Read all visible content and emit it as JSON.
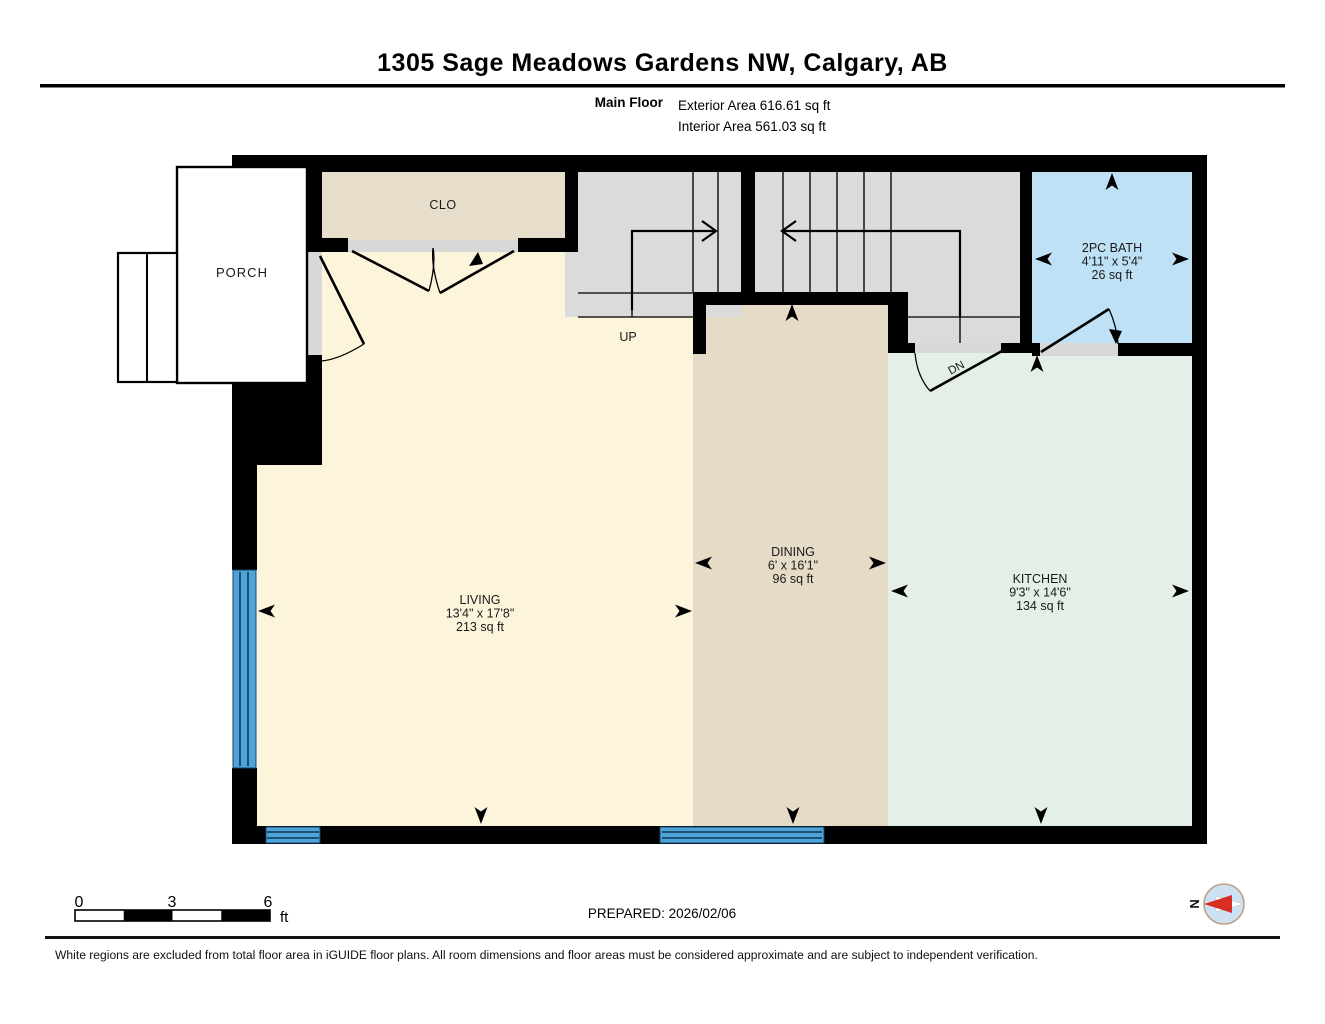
{
  "header": {
    "title": "1305 Sage Meadows Gardens NW, Calgary, AB",
    "floor_label": "Main Floor",
    "exterior_area": "Exterior Area 616.61 sq ft",
    "interior_area": "Interior Area 561.03 sq ft"
  },
  "rooms": {
    "porch": {
      "name": "PORCH"
    },
    "closet": {
      "name": "CLO"
    },
    "living": {
      "name": "LIVING",
      "dims": "13'4\" x 17'8\"",
      "area": "213 sq ft"
    },
    "dining": {
      "name": "DINING",
      "dims": "6' x 16'1\"",
      "area": "96 sq ft"
    },
    "kitchen": {
      "name": "KITCHEN",
      "dims": "9'3\" x 14'6\"",
      "area": "134 sq ft"
    },
    "bath": {
      "name": "2PC BATH",
      "dims": "4'11\" x 5'4\"",
      "area": "26 sq ft"
    },
    "stairs_up_label": "UP",
    "stairs_down_label": "DN"
  },
  "scale_bar": {
    "tick_0": "0",
    "tick_3": "3",
    "tick_6": "6",
    "unit": "ft"
  },
  "prepared_label": "PREPARED: 2026/02/06",
  "compass": {
    "north_label": "N"
  },
  "footer": {
    "disclaimer": "White regions are excluded from total floor area in iGUIDE floor plans. All room dimensions and floor areas must be considered approximate and are subject to independent verification."
  },
  "colors": {
    "wall": "#000000",
    "living": "#FCF5DB",
    "dining": "#E5DBC6",
    "kitchen": "#E4EFE8",
    "closet": "#E7DDCB",
    "bath": "#BEE1F6",
    "stairs": "#DBDBDB",
    "landing": "#DBDBDB",
    "door_opening": "#D8D8D8",
    "window": "#4FA3D6",
    "compass_red": "#D62E20"
  }
}
